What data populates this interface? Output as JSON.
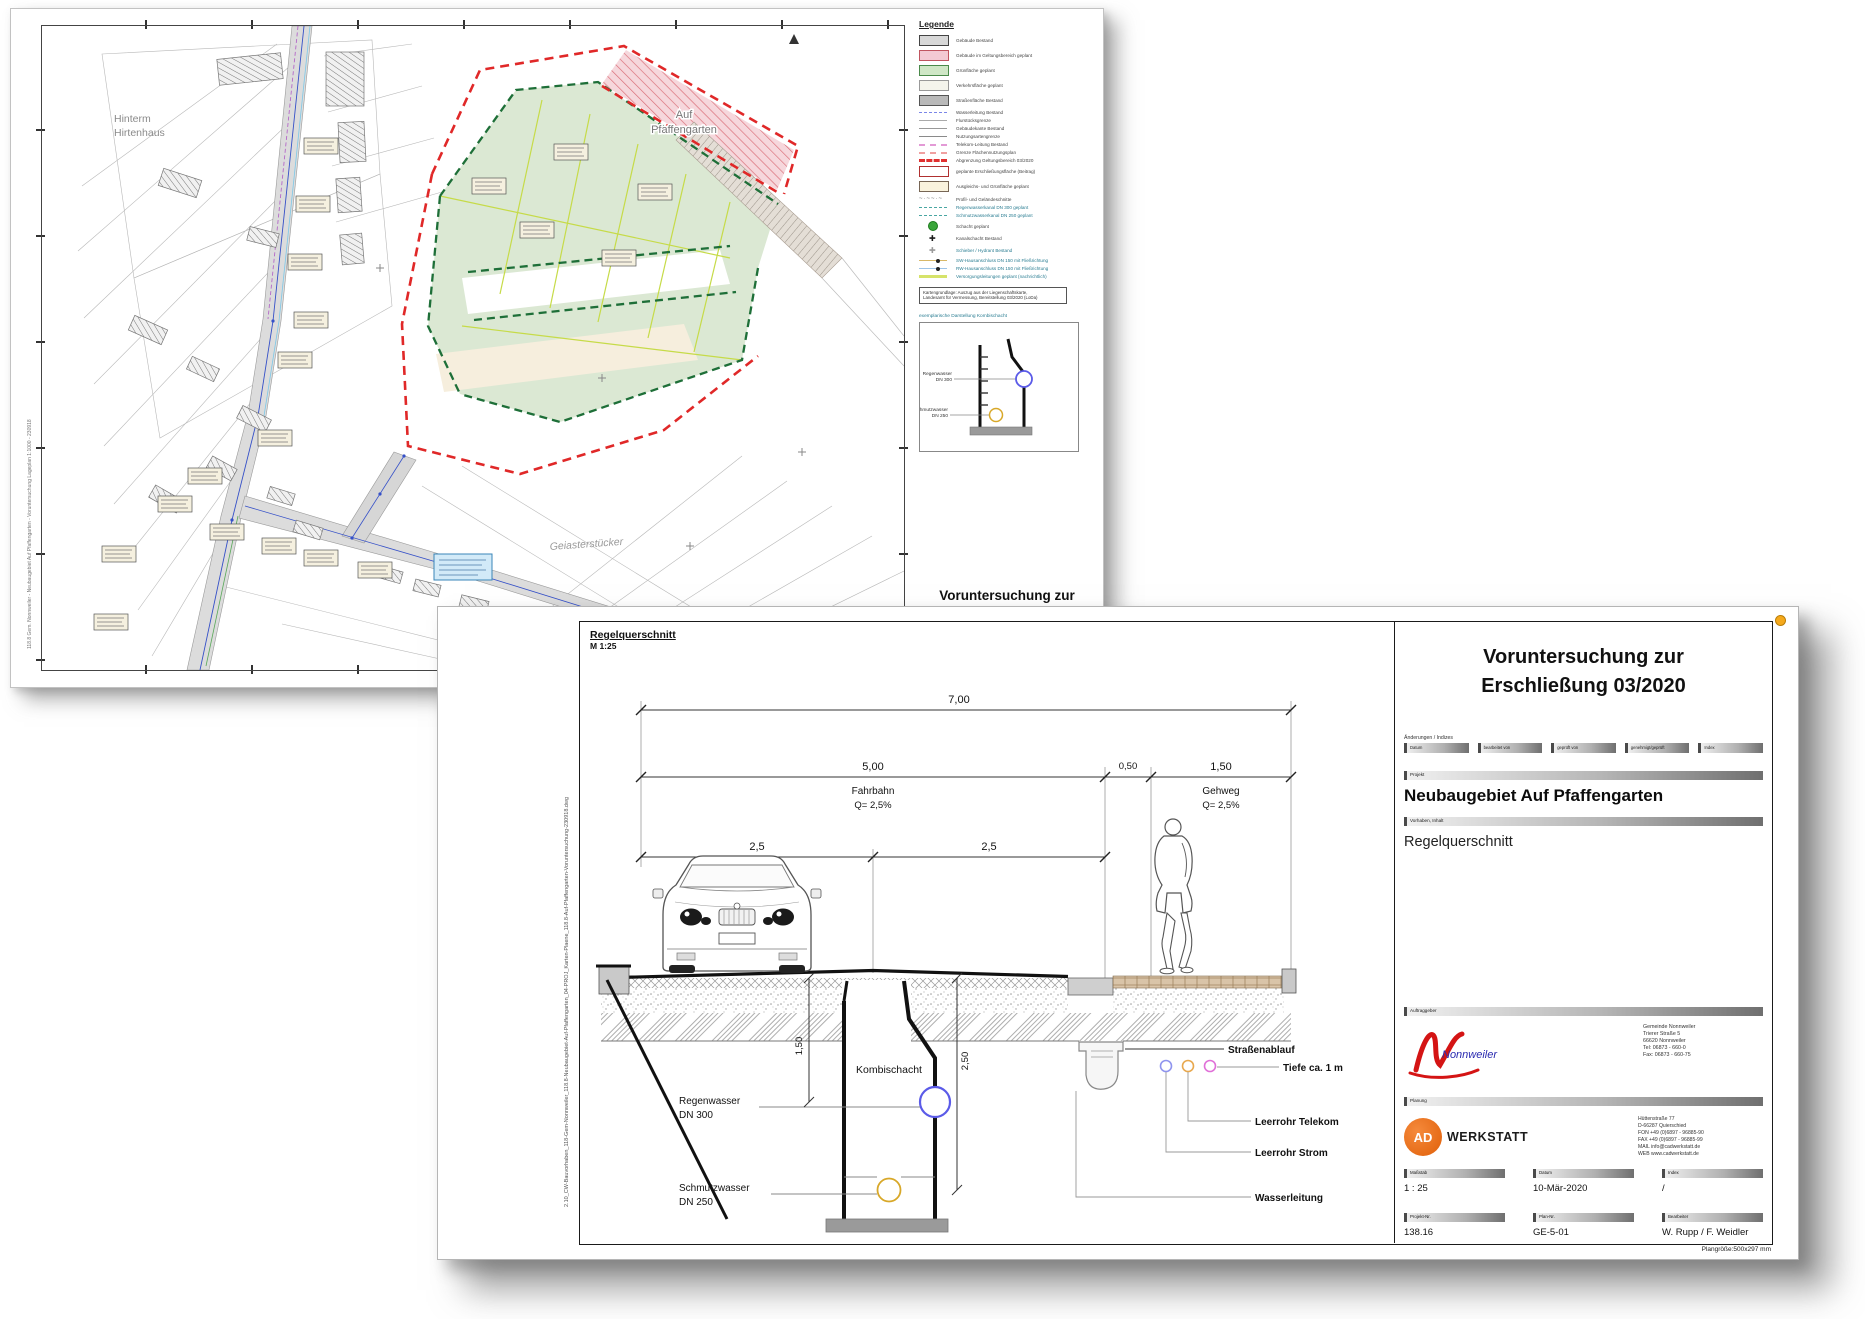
{
  "page1": {
    "map_labels": {
      "field_nw_line1": "Hinterm",
      "field_nw_line2": "Hirtenhaus",
      "area_line1": "Auf",
      "area_line2": "Pfaffengarten",
      "field_se": "Geiasterstücker"
    },
    "side_text": "118.8 Gem. Nonnweiler - Neubaugebiet Auf Pfaffengarten - Voruntersuchung Lageplan 1:1000 - 230918",
    "legend": {
      "title": "Legende",
      "items": [
        {
          "kind": "rect",
          "fill": "#d8d8d8",
          "stroke": "#444",
          "label": "Gebäude Bestand",
          "lc": "#444"
        },
        {
          "kind": "rect",
          "fill": "#f3c9d3",
          "stroke": "#c05560",
          "label": "Gebäude im Geltungsbereich geplant",
          "lc": "#444"
        },
        {
          "kind": "rect",
          "fill": "#cfe7c6",
          "stroke": "#4a8a4a",
          "label": "Grünfläche geplant",
          "lc": "#444"
        },
        {
          "kind": "rect",
          "fill": "#f4f4ec",
          "stroke": "#999",
          "label": "Verkehrsfläche geplant",
          "lc": "#444"
        },
        {
          "kind": "rect",
          "fill": "#b9b9b9",
          "stroke": "#555",
          "label": "Straßenfläche Bestand",
          "lc": "#444"
        },
        {
          "kind": "line",
          "color": "#7a86e8",
          "dash": true,
          "w": 1.5,
          "label": "Wasserleitung Bestand",
          "lc": "#444"
        },
        {
          "kind": "line",
          "color": "#aaaaaa",
          "dash": false,
          "w": 1.5,
          "label": "Flurstücksgrenze",
          "lc": "#444"
        },
        {
          "kind": "line",
          "color": "#999999",
          "dash": false,
          "w": 1.5,
          "label": "Gebäudekante Bestand",
          "lc": "#444"
        },
        {
          "kind": "line",
          "color": "#8a8a8a",
          "dash": false,
          "w": 1.5,
          "label": "Nutzungsartengrenze",
          "lc": "#444"
        },
        {
          "kind": "line",
          "color": "#e39ad6",
          "dash": true,
          "w": 2,
          "label": "Telekom-Leitung Bestand",
          "lc": "#444"
        },
        {
          "kind": "line",
          "color": "#f0a0a0",
          "dash": true,
          "w": 2,
          "label": "Grenze Flächennutzungsplan",
          "lc": "#444"
        },
        {
          "kind": "line",
          "color": "#e03030",
          "dash": true,
          "w": 3.5,
          "label": "Abgrenzung Geltungsbereich 03/2020",
          "lc": "#444"
        },
        {
          "kind": "rect",
          "fill": "#ffffff",
          "stroke": "#b03030",
          "label": "geplante Erschließungsfläche (Beitrag)",
          "lc": "#444"
        },
        {
          "kind": "rect",
          "fill": "#faf3dd",
          "stroke": "#776655",
          "label": "Ausgleichs- und Grünfläche geplant",
          "lc": "#444"
        },
        {
          "kind": "squiggle",
          "label": "Profil- und Geländeschnitte",
          "lc": "#444"
        },
        {
          "kind": "line",
          "color": "#49a6a2",
          "dash": true,
          "w": 1.5,
          "label": "Regenwasserkanal DN 300 geplant",
          "lc": "#2a7d92"
        },
        {
          "kind": "line",
          "color": "#49a6a2",
          "dash": true,
          "w": 1.5,
          "label": "Schmutzwasserkanal DN 250 geplant",
          "lc": "#2a7d92"
        },
        {
          "kind": "circle",
          "color": "#3aa53a",
          "border": "#1c7a1c",
          "label": "Schacht geplant",
          "lc": "#444"
        },
        {
          "kind": "cross",
          "color": "#1a1a1a",
          "label": "Kanalschacht Bestand",
          "lc": "#444"
        },
        {
          "kind": "cross",
          "color": "#9a9a9a",
          "label": "Schieber / Hydrant Bestand",
          "lc": "#2a7d92"
        },
        {
          "kind": "line2",
          "c1": "#d8b868",
          "c2": "#222222",
          "label": "SW-Hausanschluss DN 150 mit Fließrichtung",
          "lc": "#2a7d92"
        },
        {
          "kind": "line2",
          "c1": "#9ec4e8",
          "c2": "#222222",
          "label": "RW-Hausanschluss DN 150 mit Fließrichtung",
          "lc": "#2a7d92"
        },
        {
          "kind": "line",
          "color": "#d6e36a",
          "dash": false,
          "w": 3,
          "label": "Versorgungsleitungen geplant (nachrichtlich)",
          "lc": "#2a7d92"
        }
      ],
      "source_lines": [
        "Kartengrundlage: Auszug aus der Liegenschaftskarte,",
        "Landesamt für Vermessung, Bereitstellung 03/2020 (LoDa)"
      ],
      "detail_caption": "exemplarische Darstellung Kombischacht",
      "detail": {
        "rw1": "Regenwasser",
        "rw2": "DN 300",
        "sw1": "Schmutzwasser",
        "sw2": "DN 250"
      }
    },
    "bottom_title": [
      "Voruntersuchung zur",
      "Erschließung 03/2020"
    ]
  },
  "page2": {
    "drawing": {
      "title": "Regelquerschnitt",
      "scale": "M 1:25",
      "side_text": "2.10_CW-Bauvorhaben_118-Gem-Nonnweiler_118.8-Neubaugebiet-Auf-Pfaffengarten_04-PROJ_Karten-Plaene_118.8-Auf-Pfaffengarten-Voruntersuchung-230918.dwg",
      "dims": {
        "total": "7,00",
        "fahrbahn_w": "5,00",
        "gutter_w": "0,50",
        "gehweg_w": "1,50",
        "half_left": "2,5",
        "half_right": "2,5",
        "depth_rw": "1,50",
        "depth_sw": "2,50"
      },
      "labels": {
        "fahrbahn": "Fahrbahn",
        "fahrbahn_q": "Q= 2,5%",
        "gehweg": "Gehweg",
        "gehweg_q": "Q= 2,5%",
        "schacht": "Kombischacht",
        "rw1": "Regenwasser",
        "rw2": "DN 300",
        "sw1": "Schmutzwasser",
        "sw2": "DN 250",
        "drain": "Straßenablauf",
        "tiefe": "Tiefe ca. 1 m",
        "telekom": "Leerrohr Telekom",
        "strom": "Leerrohr Strom",
        "wasser": "Wasserleitung"
      }
    },
    "titleblock": {
      "title_line1": "Voruntersuchung zur",
      "title_line2": "Erschließung 03/2020",
      "aend_label": "Änderungen / Indizes",
      "aend_cols": [
        "Datum",
        "bearbeitet von",
        "geprüft von",
        "genehmigt/geprüft",
        "Index"
      ],
      "projekt_label": "Projekt",
      "projekt": "Neubaugebiet Auf Pfaffengarten",
      "vorhaben_label": "Vorhaben, Inhalt",
      "vorhaben": "Regelquerschnitt",
      "auftraggeber_label": "Auftraggeber",
      "auftraggeber_logo_text": "Nonnweiler",
      "auftraggeber_address": [
        "Gemeinde Nonnweiler",
        "Trierer Straße 5",
        "66620 Nonnweiler",
        "Tel: 06873 - 660-0",
        "Fax: 06873 - 660-75"
      ],
      "planung_label": "Planung",
      "planung_logo_ad": "AD",
      "planung_logo_name": "WERKSTATT",
      "planung_address": [
        "Hüttenstraße 77",
        "D-66287 Quierschied",
        "FON  +49 (0)6897 - 96885-90",
        "FAX  +49 (0)6897 - 96885-99",
        "MAIL  info@cadwerkstatt.de",
        "WEB  www.cadwerkstatt.de"
      ],
      "fields": [
        {
          "label": "Maßstab",
          "value": "1 : 25"
        },
        {
          "label": "Datum",
          "value": "10-Mär-2020"
        },
        {
          "label": "Index",
          "value": "/"
        },
        {
          "label": "Projekt-Nr.",
          "value": "138.16"
        },
        {
          "label": "Plan-Nr.",
          "value": "GE-5-01"
        },
        {
          "label": "Bearbeiter",
          "value": "W. Rupp / F. Weidler"
        }
      ],
      "plansize": "Plangröße:500x297 mm"
    }
  }
}
